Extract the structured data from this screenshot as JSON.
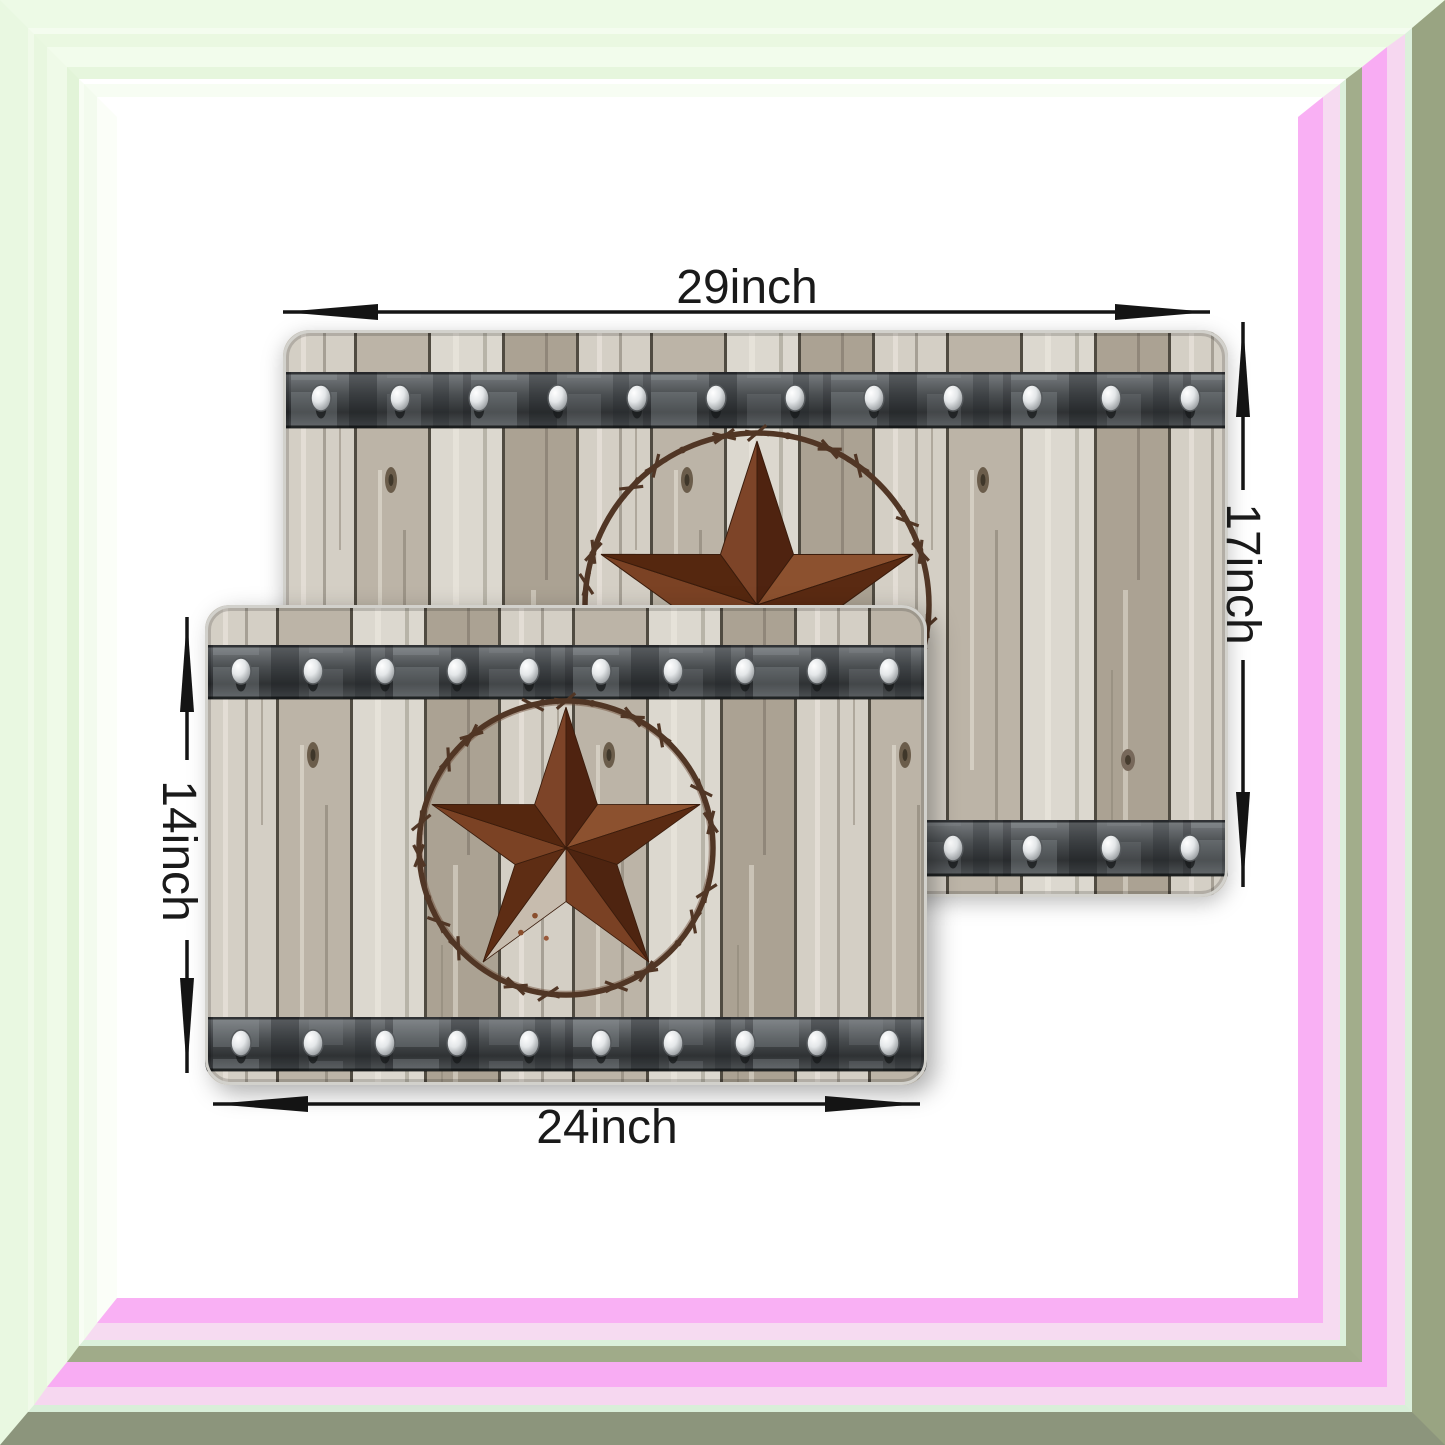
{
  "image": {
    "description": "Two rustic barn-door style mats with western barn star design shown with size annotations",
    "dimensions": {
      "back_mat_width": "29inch",
      "back_mat_height": "17inch",
      "front_mat_height": "14inch",
      "front_mat_width": "24inch"
    },
    "colors": {
      "frame_pink": "#f8acf3",
      "frame_mint": "#d9efd9",
      "frame_sage": "#9aa584",
      "frame_pale_green": "#eafae2",
      "annotation": "#1a1a1a",
      "star_rust_dark": "#54260e",
      "star_rust_light": "#8c512f",
      "star_weathered": "#c7bcae",
      "wire_brown": "#513625",
      "metal_band": "#35383b",
      "wood_light": "#d6d2c8",
      "wood_dark": "#aba293"
    }
  }
}
